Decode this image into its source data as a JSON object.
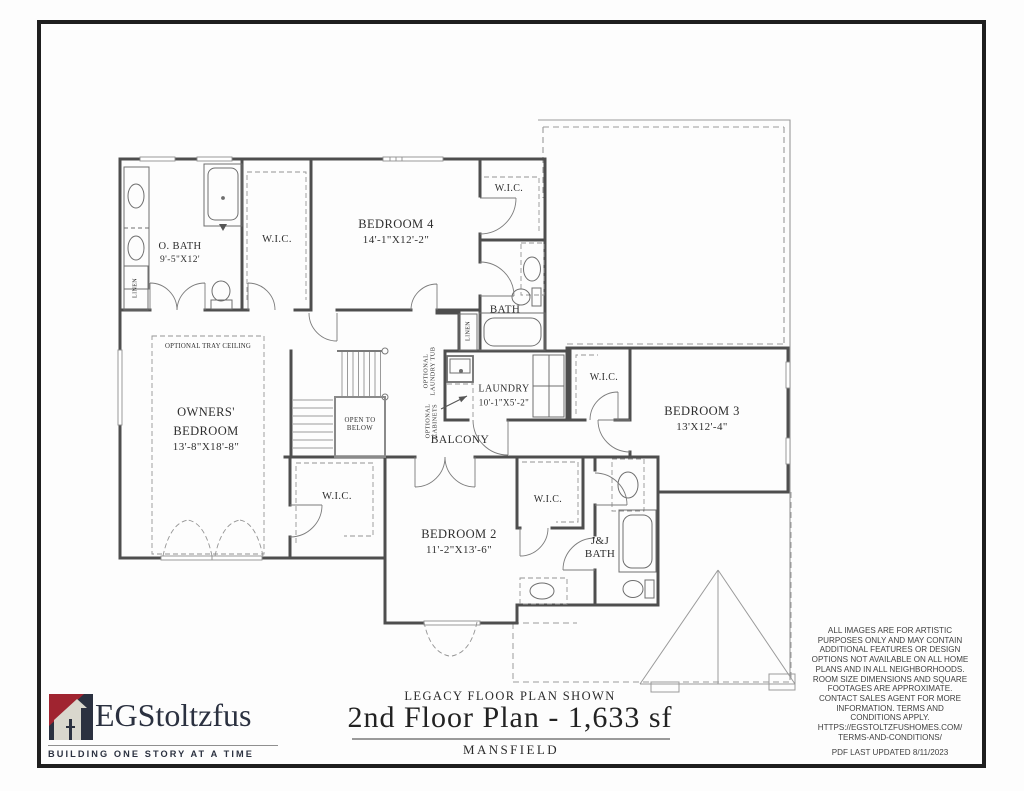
{
  "title_block": {
    "plan_note": "LEGACY FLOOR PLAN SHOWN",
    "plan_title": "2nd Floor Plan - 1,633 sf",
    "model_name": "MANSFIELD"
  },
  "logo": {
    "brand": "EGStoltzfus",
    "tagline": "BUILDING ONE STORY AT A TIME"
  },
  "disclaimer": {
    "body": "ALL IMAGES ARE FOR ARTISTIC PURPOSES ONLY AND MAY CONTAIN ADDITIONAL FEATURES OR DESIGN OPTIONS NOT AVAILABLE ON ALL HOME PLANS AND IN ALL NEIGHBORHOODS.  ROOM SIZE DIMENSIONS AND SQUARE FOOTAGES ARE APPROXIMATE.  CONTACT SALES AGENT FOR MORE INFORMATION.  TERMS AND CONDITIONS APPLY. HTTPS://EGSTOLTZFUSHOMES.COM/ TERMS-AND-CONDITIONS/",
    "last_updated": "PDF LAST UPDATED 8/11/2023"
  },
  "rooms": {
    "owners_bedroom": {
      "name": "OWNERS'\nBEDROOM",
      "dims": "13'-8\"X18'-8\""
    },
    "owners_bath": {
      "name": "O. BATH",
      "dims": "9'-5\"X12'"
    },
    "bedroom_2": {
      "name": "BEDROOM 2",
      "dims": "11'-2\"X13'-6\""
    },
    "bedroom_3": {
      "name": "BEDROOM 3",
      "dims": "13'X12'-4\""
    },
    "bedroom_4": {
      "name": "BEDROOM 4",
      "dims": "14'-1\"X12'-2\""
    },
    "laundry": {
      "name": "LAUNDRY",
      "dims": "10'-1\"X5'-2\""
    },
    "bath": {
      "name": "BATH"
    },
    "jj_bath": {
      "name": "J&J\nBATH"
    },
    "balcony": {
      "name": "BALCONY"
    },
    "wic": {
      "name": "W.I.C."
    },
    "linen": {
      "name": "LINEN"
    },
    "open_to_below": {
      "name": "OPEN TO\nBELOW"
    },
    "optional_tray_ceiling": {
      "name": "OPTIONAL TRAY CEILING"
    },
    "optional_laundry_tub": {
      "name": "OPTIONAL\nLAUNDRY TUB"
    },
    "optional_cabinets": {
      "name": "OPTIONAL\nCABINETS"
    }
  },
  "colors": {
    "logo_navy": "#2b3140",
    "logo_red": "#a02430",
    "wall_gray": "#4e4e4e"
  }
}
